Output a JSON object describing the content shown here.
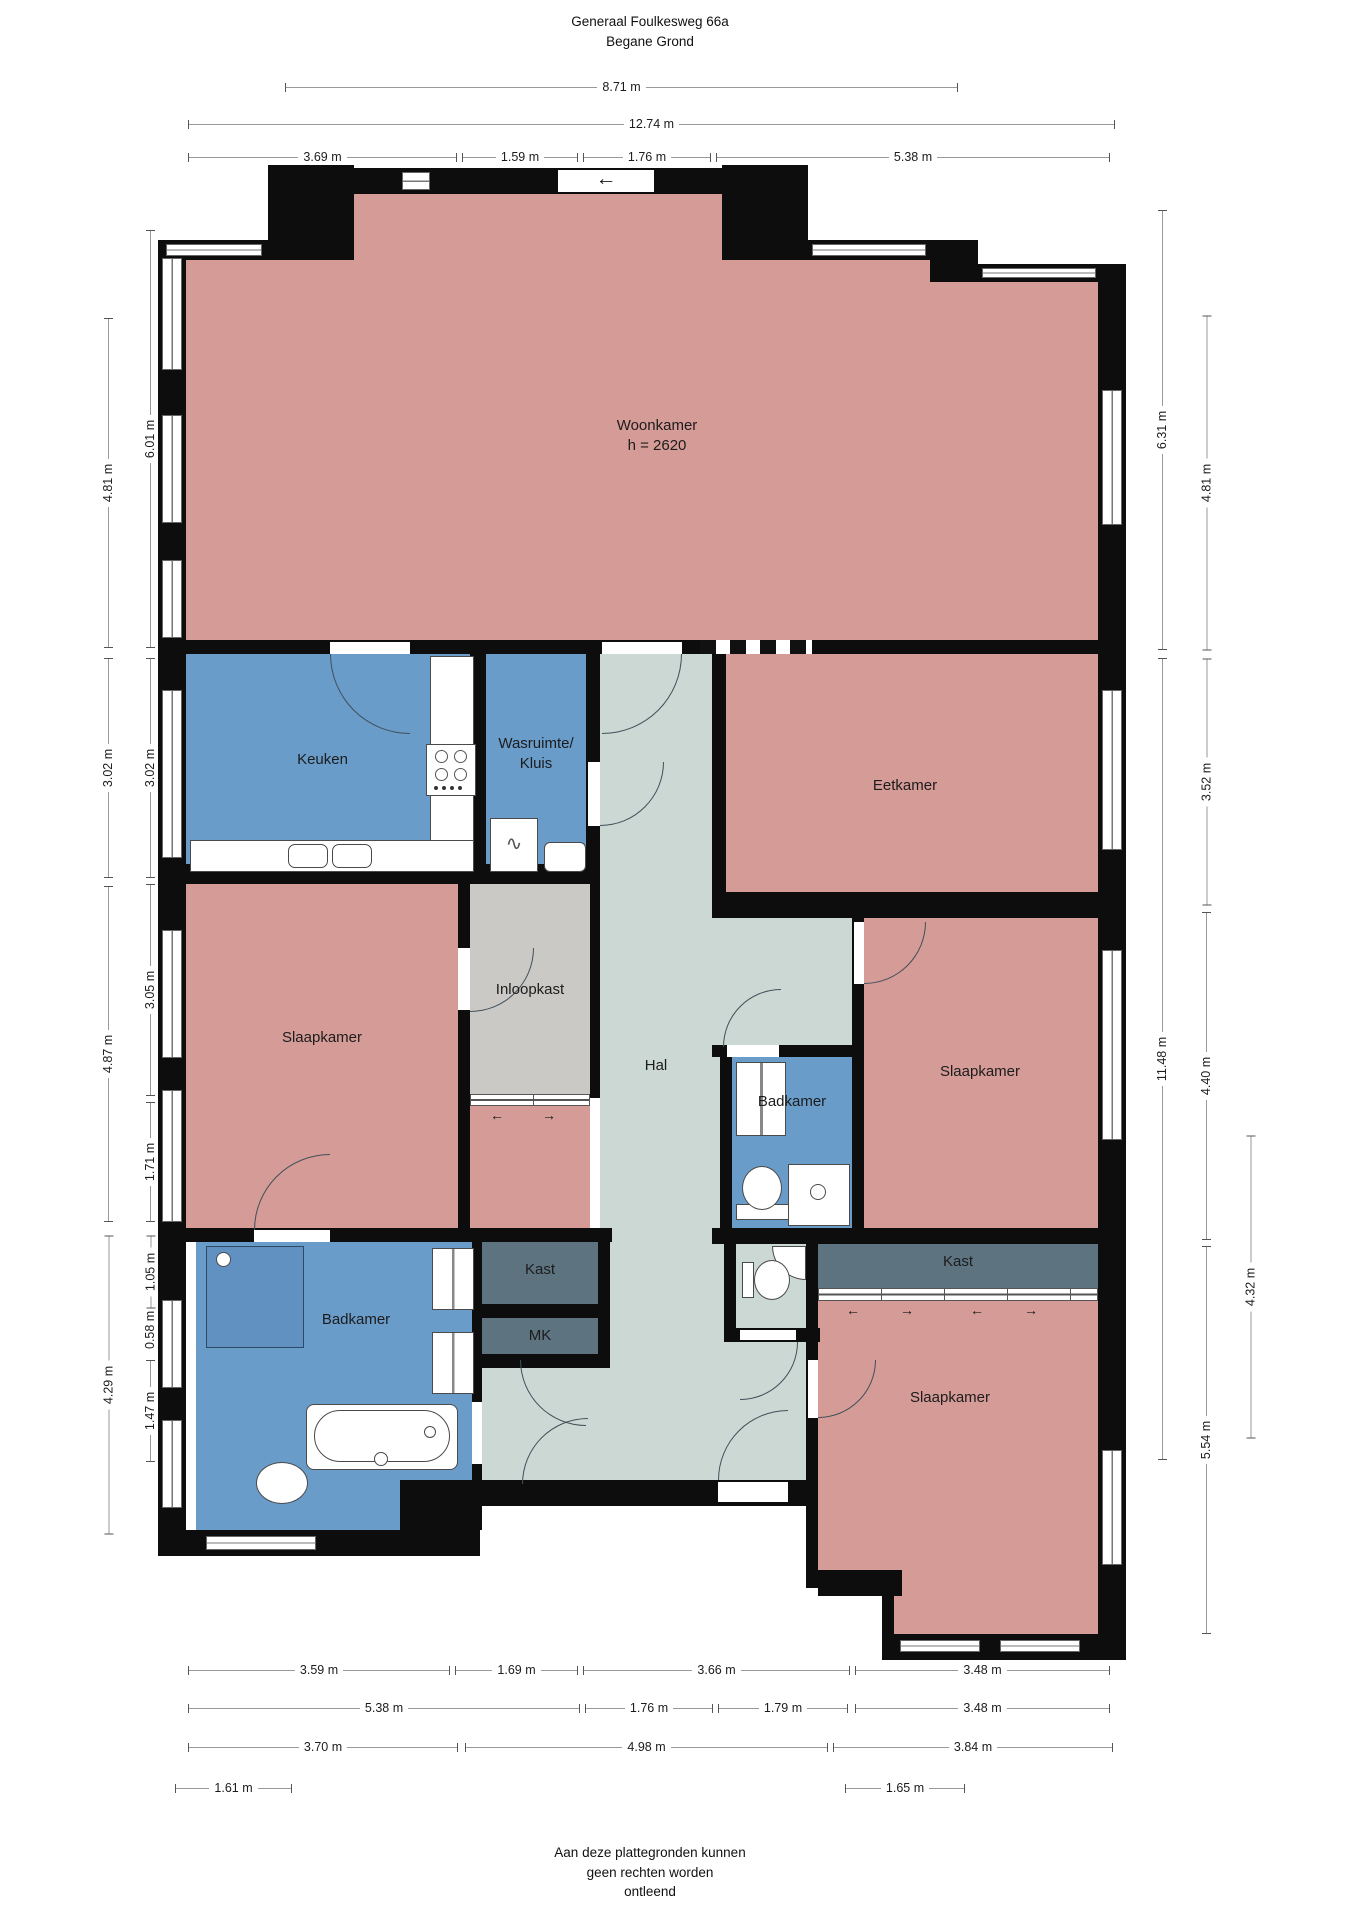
{
  "title": {
    "line1": "Generaal Foulkesweg 66a",
    "line2": "Begane Grond"
  },
  "footer": {
    "line1": "Aan deze plattegronden kunnen",
    "line2": "geen rechten worden",
    "line3": "ontleend"
  },
  "rooms": {
    "woonkamer": {
      "label": "Woonkamer",
      "height_note": "h = 2620"
    },
    "keuken": {
      "label": "Keuken"
    },
    "wasruimte": {
      "label_line1": "Wasruimte/",
      "label_line2": "Kluis"
    },
    "eetkamer": {
      "label": "Eetkamer"
    },
    "hal": {
      "label": "Hal"
    },
    "inloopkast": {
      "label": "Inloopkast"
    },
    "slaapkamer_left": {
      "label": "Slaapkamer"
    },
    "badkamer_mid": {
      "label": "Badkamer"
    },
    "slaapkamer_right": {
      "label": "Slaapkamer"
    },
    "kast_right": {
      "label": "Kast"
    },
    "badkamer_left": {
      "label": "Badkamer"
    },
    "kast_left": {
      "label": "Kast"
    },
    "mk": {
      "label": "MK"
    },
    "slaapkamer_bottom": {
      "label": "Slaapkamer"
    }
  },
  "icons": {
    "entry_arrow": "←",
    "slide_left": "←",
    "slide_right": "→"
  },
  "colors": {
    "room_pink": "#d59b97",
    "room_blue": "#6a9cca",
    "room_hal": "#ccd8d4",
    "room_gray": "#cbc9c6",
    "room_slate": "#5e7380",
    "shower_blue": "#6191c1",
    "wall": "#0d0d0d"
  },
  "dimensions": {
    "top": [
      "8.71 m",
      "12.74 m",
      "3.69 m",
      "1.59 m",
      "1.76 m",
      "5.38 m"
    ],
    "left_outer": [
      "4.81 m",
      "3.02 m",
      "4.87 m",
      "4.29 m"
    ],
    "left_inner": [
      "6.01 m",
      "3.02 m",
      "3.05 m",
      "1.71 m",
      "1.05 m",
      "0.58 m",
      "1.47 m"
    ],
    "right_inner": [
      "6.31 m",
      "11.48 m"
    ],
    "right_outer": [
      "4.81 m",
      "3.52 m",
      "4.40 m",
      "5.54 m"
    ],
    "right_far": [
      "4.32 m"
    ],
    "bottom_row1": [
      "3.59 m",
      "1.69 m",
      "3.66 m",
      "3.48 m"
    ],
    "bottom_row2": [
      "5.38 m",
      "1.76 m",
      "1.79 m",
      "3.48 m"
    ],
    "bottom_row3": [
      "3.70 m",
      "4.98 m",
      "3.84 m"
    ],
    "bottom_row4": [
      "1.61 m",
      "1.65 m"
    ]
  }
}
